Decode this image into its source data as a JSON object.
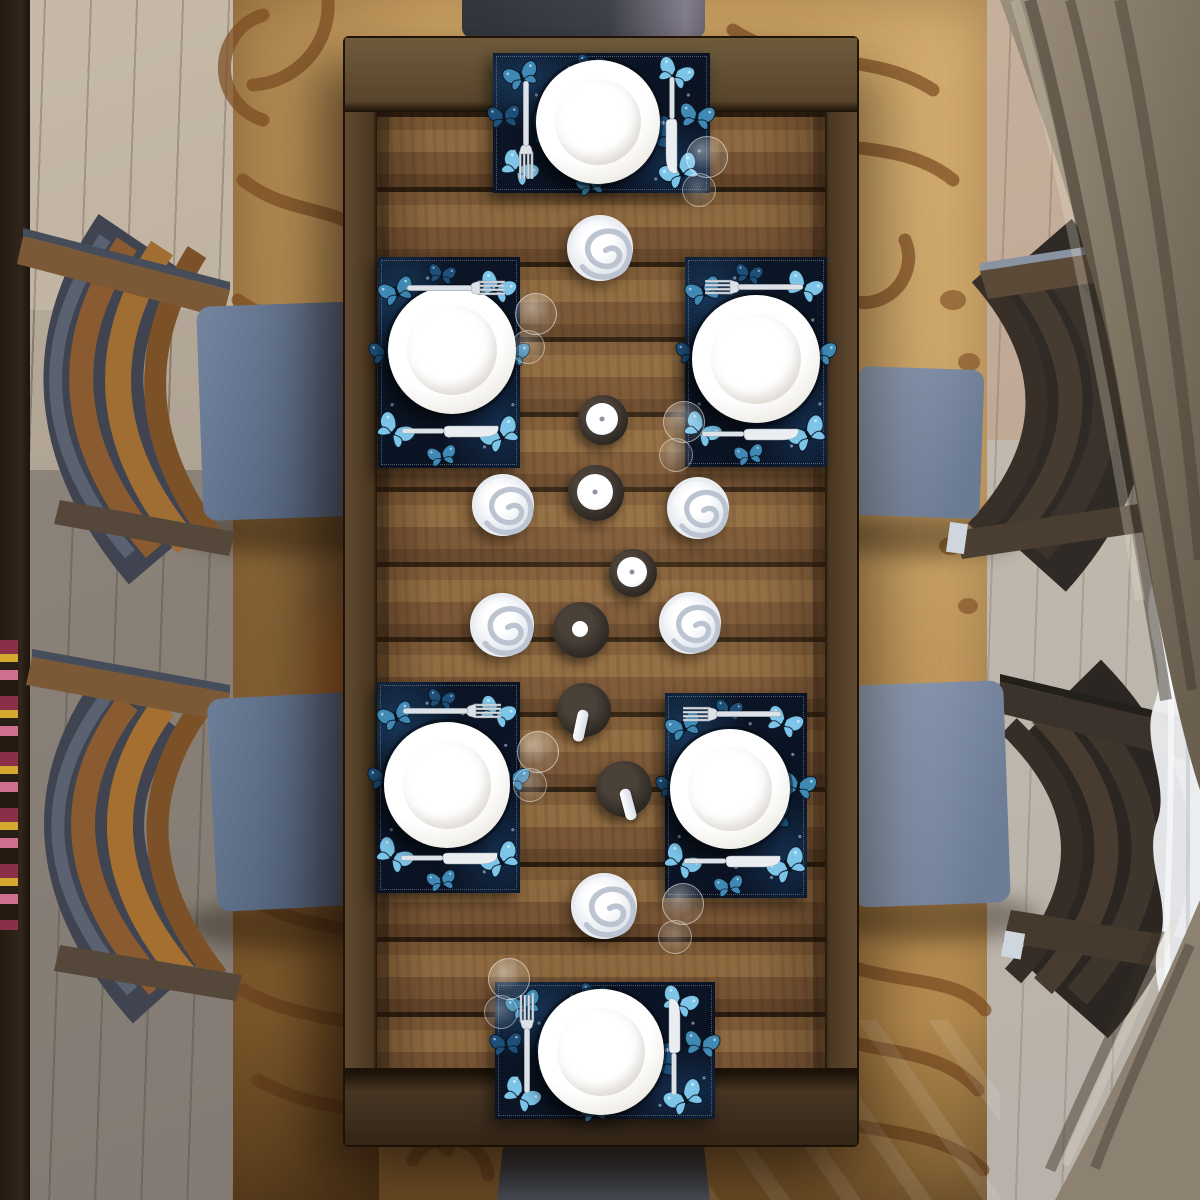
{
  "scene_type": "top-down dining table product photo, butterfly placemats set for six",
  "palette": {
    "floor_base": "#b4a898",
    "left_strip": "#30251a",
    "rug_base": "#c79e60",
    "rug_dark": "#7b4c22",
    "table_frame": "#5b472e",
    "plank_light": "#8f6a40",
    "plank_mid": "#7d5a36",
    "plank_dark": "#64452a",
    "mat_bg": "#0b1424",
    "plate_white": "#ffffff",
    "silver": "#dde2e8",
    "candle_shadow": "#c6ccd8",
    "holder_dark": "#36302a",
    "holder_edge": "#1a1612",
    "chair_head": "#3f424a",
    "curtain_taupe": "#958876",
    "curtain_taupe_dark": "#6b6050",
    "sheer_white": "#eef0f3",
    "seat_left_light": "#74859f",
    "seat_left_dark": "#4b5a74",
    "seat_right_light": "#97a6bd",
    "seat_right_dark": "#6e7d96",
    "slat_wood": [
      "#8a5a30",
      "#a06e33",
      "#7c5128"
    ],
    "slat_espresso": [
      "#3e352c",
      "#483c30",
      "#352d26"
    ],
    "slat_highlight": "#c8d2de",
    "chair_frame_gray": "#5a6170",
    "butterfly_colors": [
      "#7cc4e8",
      "#3f89b4",
      "#1d4f79"
    ]
  },
  "placemat_pattern": {
    "butterflies": [
      [
        0.13,
        0.16,
        44,
        -20,
        1
      ],
      [
        0.45,
        0.08,
        34,
        10,
        2
      ],
      [
        0.84,
        0.14,
        46,
        25,
        0
      ],
      [
        0.05,
        0.45,
        40,
        -5,
        2
      ],
      [
        0.94,
        0.45,
        44,
        10,
        1
      ],
      [
        0.12,
        0.82,
        48,
        35,
        0
      ],
      [
        0.45,
        0.94,
        36,
        -10,
        1
      ],
      [
        0.86,
        0.84,
        50,
        -30,
        0
      ],
      [
        0.3,
        0.55,
        70,
        15,
        2
      ],
      [
        0.72,
        0.6,
        64,
        -20,
        2
      ]
    ],
    "sparkles": [
      [
        0.2,
        0.3
      ],
      [
        0.6,
        0.15
      ],
      [
        0.9,
        0.3
      ],
      [
        0.1,
        0.7
      ],
      [
        0.5,
        0.85
      ],
      [
        0.95,
        0.7
      ],
      [
        0.35,
        0.1
      ],
      [
        0.75,
        0.9
      ]
    ]
  },
  "placemats": [
    {
      "name": "placemat-top",
      "x": 493,
      "y": 53,
      "w": 217,
      "h": 140,
      "plate": {
        "cx": 105,
        "cy": 69,
        "r": 62
      },
      "fork": {
        "cx": 33,
        "cy": 76,
        "rot": 180
      },
      "knife": {
        "cx": 179,
        "cy": 72,
        "rot": 180
      }
    },
    {
      "name": "placemat-upper-left",
      "x": 378,
      "y": 257,
      "w": 142,
      "h": 211,
      "plate": {
        "cx": 74,
        "cy": 93,
        "r": 64
      },
      "fork": {
        "cx": 77,
        "cy": 31,
        "rot": 90
      },
      "knife": {
        "cx": 72,
        "cy": 174,
        "rot": 90
      }
    },
    {
      "name": "placemat-upper-right",
      "x": 685,
      "y": 257,
      "w": 142,
      "h": 210,
      "plate": {
        "cx": 71,
        "cy": 102,
        "r": 64
      },
      "fork": {
        "cx": 70,
        "cy": 30,
        "rot": -90
      },
      "knife": {
        "cx": 65,
        "cy": 177,
        "rot": 90
      }
    },
    {
      "name": "placemat-lower-left",
      "x": 377,
      "y": 682,
      "w": 143,
      "h": 211,
      "plate": {
        "cx": 70,
        "cy": 103,
        "r": 63
      },
      "fork": {
        "cx": 74,
        "cy": 29,
        "rot": 90
      },
      "knife": {
        "cx": 72,
        "cy": 176,
        "rot": 90
      }
    },
    {
      "name": "placemat-lower-right",
      "x": 665,
      "y": 693,
      "w": 142,
      "h": 205,
      "plate": {
        "cx": 65,
        "cy": 96,
        "r": 60
      },
      "fork": {
        "cx": 68,
        "cy": 21,
        "rot": -90
      },
      "knife": {
        "cx": 67,
        "cy": 168,
        "rot": 90
      }
    },
    {
      "name": "placemat-bottom",
      "x": 495,
      "y": 982,
      "w": 220,
      "h": 137,
      "plate": {
        "cx": 106,
        "cy": 70,
        "r": 63
      },
      "fork": {
        "cx": 32,
        "cy": 63,
        "rot": 0
      },
      "knife": {
        "cx": 179,
        "cy": 65,
        "rot": 0
      }
    }
  ],
  "candles": [
    {
      "type": "swirl",
      "x": 600,
      "y": 248,
      "r": 33
    },
    {
      "type": "pillar",
      "x": 603,
      "y": 420,
      "r": 25,
      "wr": 16
    },
    {
      "type": "pillar",
      "x": 596,
      "y": 493,
      "r": 28,
      "wr": 18
    },
    {
      "type": "swirl",
      "x": 503,
      "y": 505,
      "r": 31
    },
    {
      "type": "swirl",
      "x": 698,
      "y": 508,
      "r": 31
    },
    {
      "type": "pillar",
      "x": 633,
      "y": 573,
      "r": 24,
      "wr": 15
    },
    {
      "type": "swirl",
      "x": 502,
      "y": 625,
      "r": 32
    },
    {
      "type": "swirl",
      "x": 690,
      "y": 623,
      "r": 31
    },
    {
      "type": "pillar",
      "x": 581,
      "y": 630,
      "r": 28,
      "wr": 8
    },
    {
      "type": "stick",
      "x": 584,
      "y": 710,
      "r": 27,
      "stem": 12
    },
    {
      "type": "stick",
      "x": 624,
      "y": 789,
      "r": 28,
      "stem": -15
    },
    {
      "type": "swirl",
      "x": 604,
      "y": 906,
      "r": 33
    }
  ],
  "glasses": [
    {
      "x": 706,
      "y": 173
    },
    {
      "x": 535,
      "y": 330
    },
    {
      "x": 683,
      "y": 438
    },
    {
      "x": 537,
      "y": 768
    },
    {
      "x": 682,
      "y": 920
    },
    {
      "x": 508,
      "y": 995
    }
  ],
  "counts": {
    "placemats": 6,
    "plates": 6,
    "forks": 6,
    "knives": 6,
    "chairs": 6,
    "wine_glasses": 6,
    "candles": 12
  }
}
